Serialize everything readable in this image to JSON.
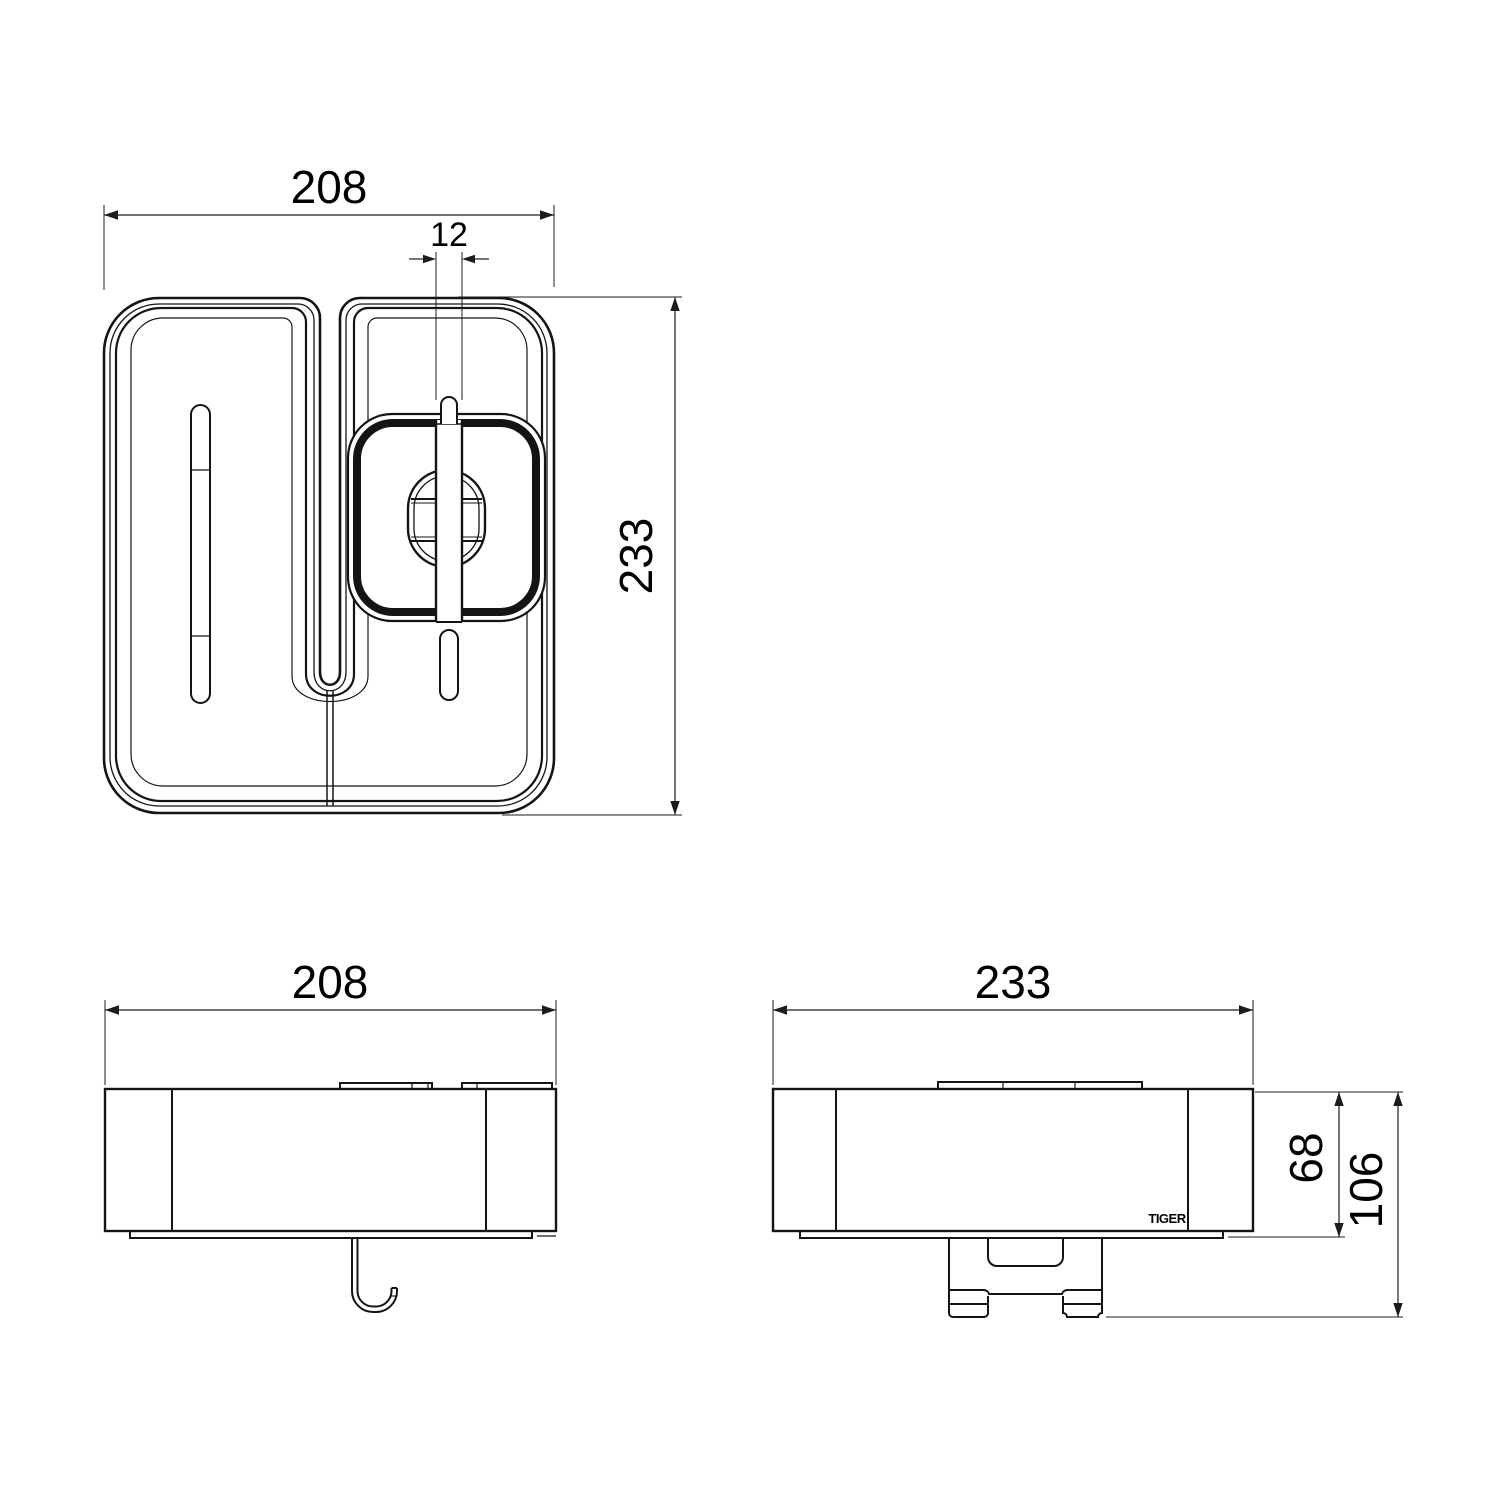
{
  "drawing": {
    "colors": {
      "line": "#141414",
      "background": "#ffffff"
    },
    "dimensions": {
      "top_width": "208",
      "hook_slot_width": "12",
      "top_depth": "233",
      "front_width": "208",
      "side_depth": "233",
      "body_height": "68",
      "total_height": "106"
    },
    "logo": "TIGER"
  }
}
